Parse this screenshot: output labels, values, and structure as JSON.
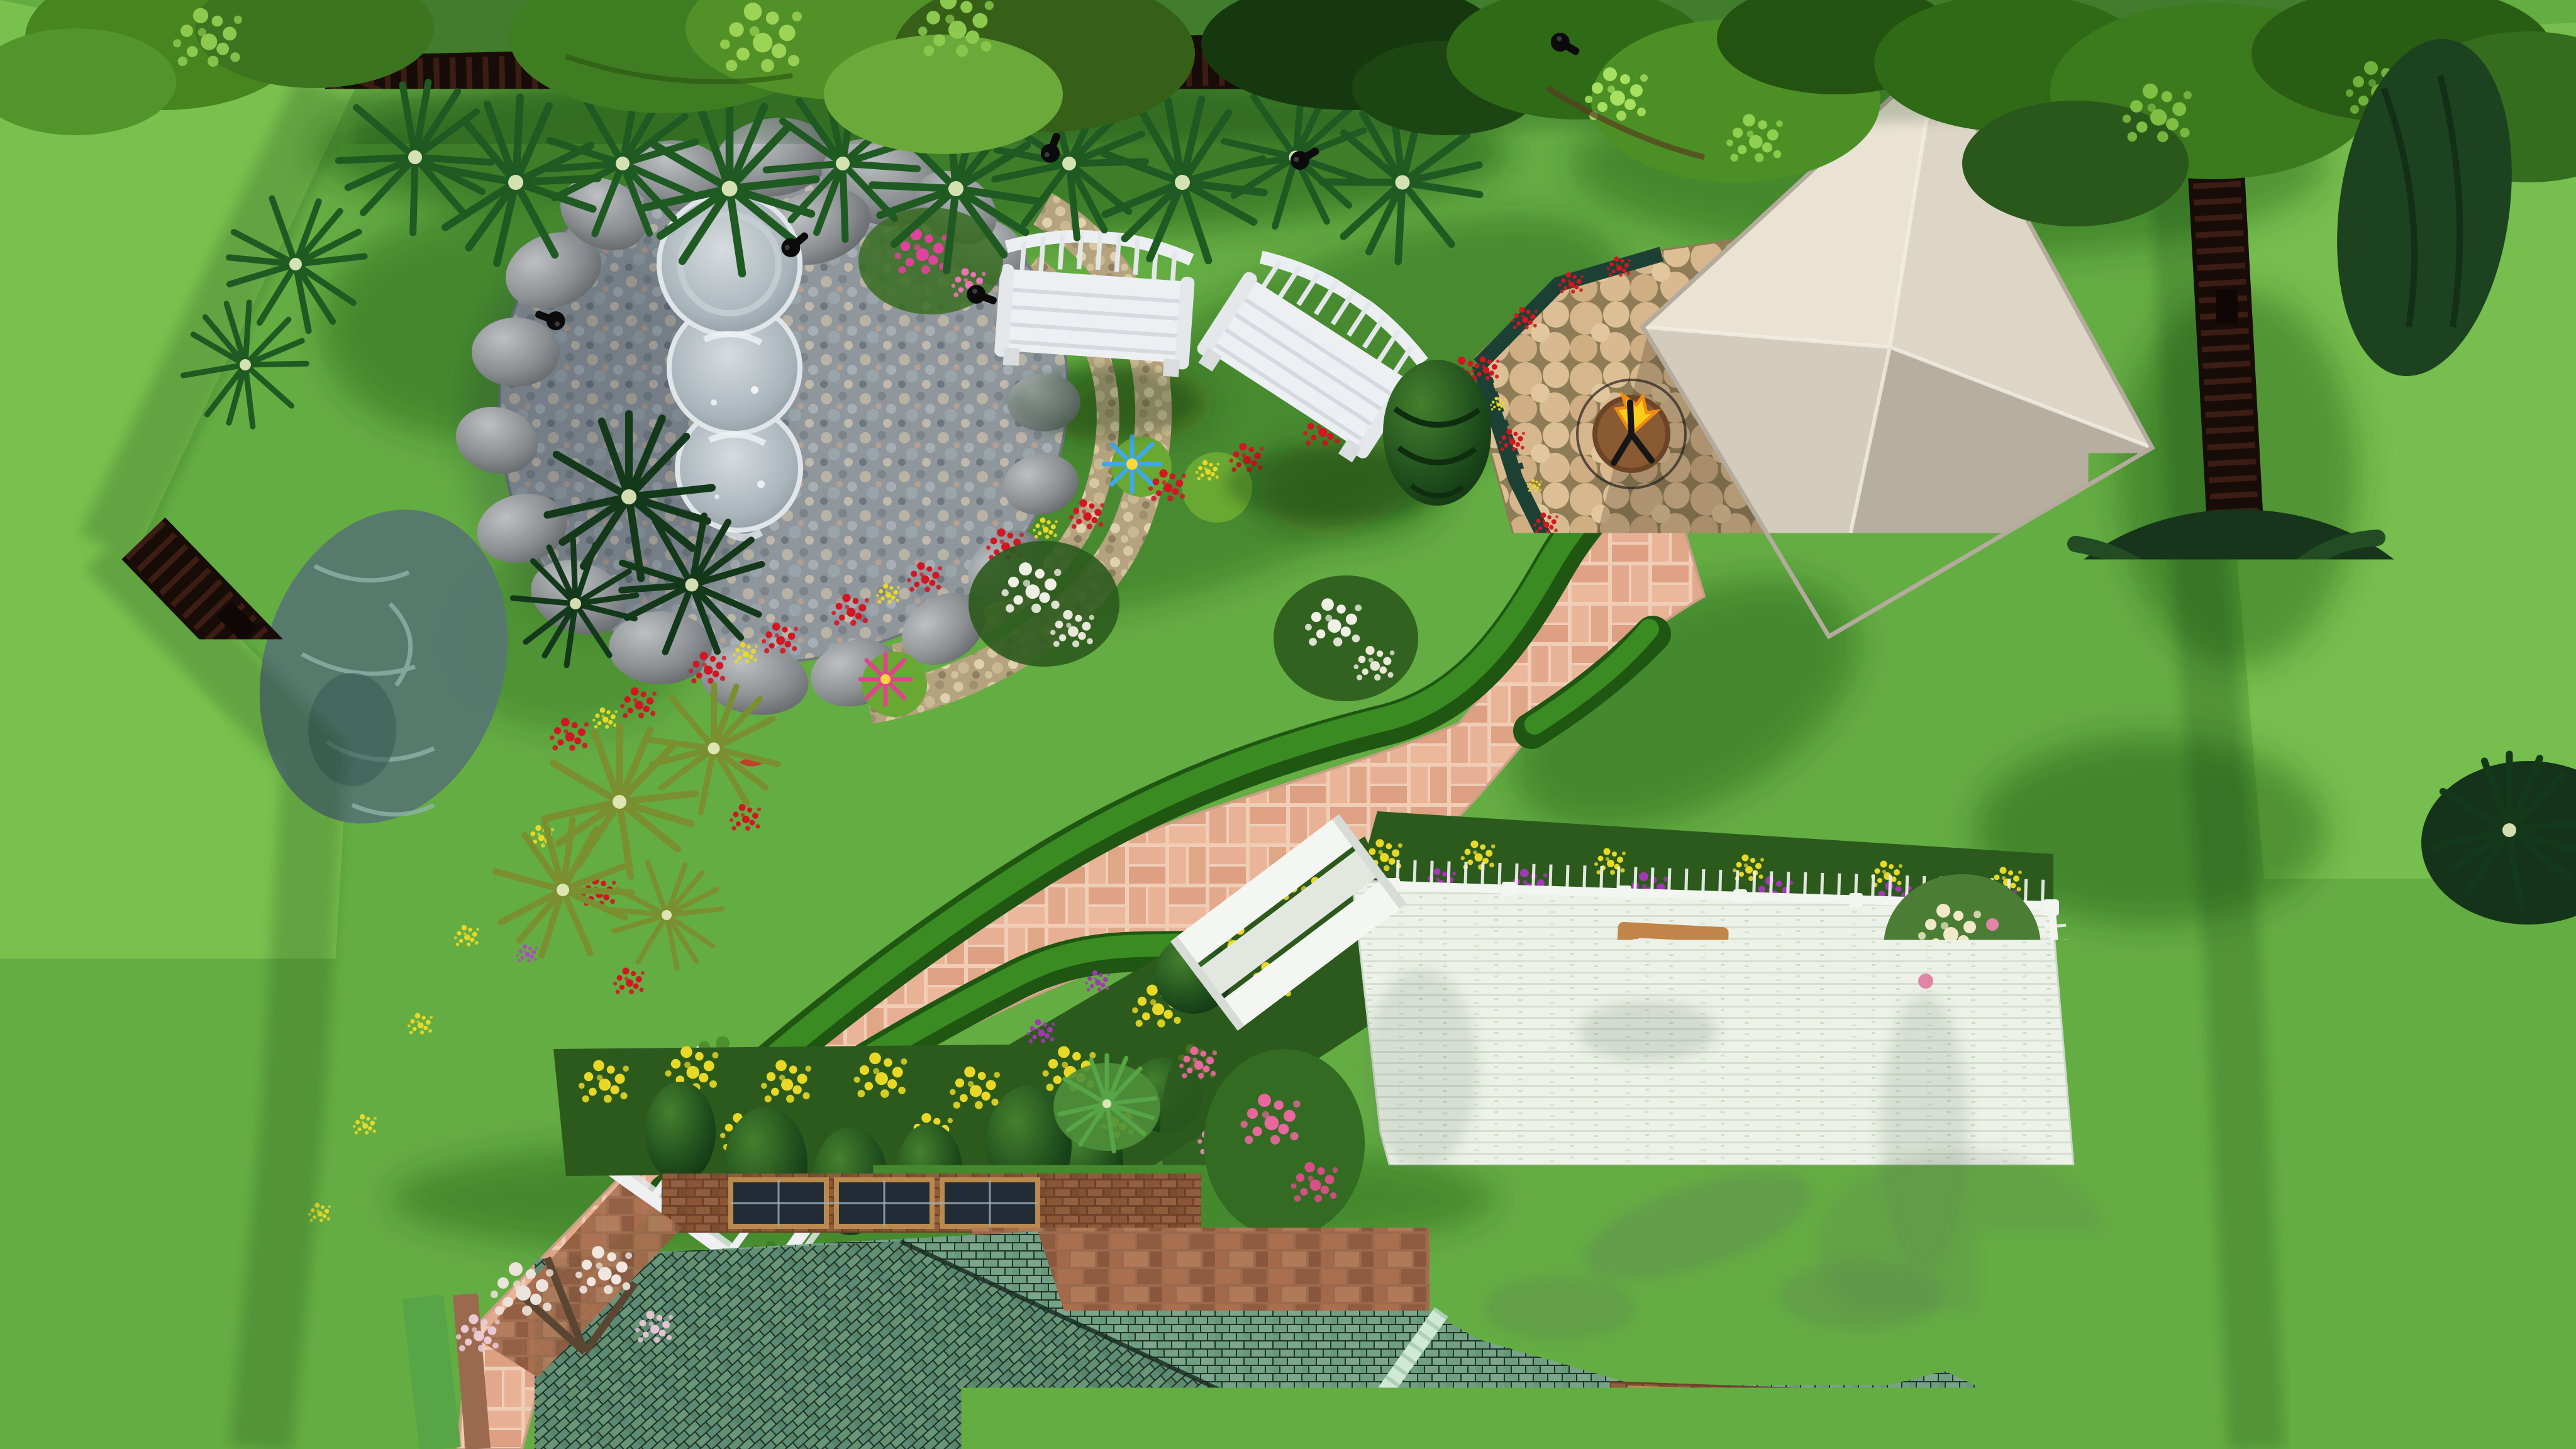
{
  "app": {
    "title": "Backyard landscape design - 3D top view render"
  },
  "palette": {
    "lawn": "#64ad43",
    "lawn_light": "#79c14f",
    "lawn_shadow": "#11340a",
    "fence_dark": "#180c08",
    "fence_slat": "#3b1d13",
    "boulder_gray": "#8d9194",
    "pebble_gray": "#919aa0",
    "pebble_tan": "#c3b18c",
    "fountain_stone": "#a9b4bc",
    "water_blue": "#3fa8e8",
    "lily_pad": "#69a832",
    "lily_pink": "#e2438a",
    "bench_white": "#edf0f2",
    "hedge_dark": "#1e5612",
    "hedge_light": "#3f9426",
    "brick_path": "#e5ae92",
    "flagstone_tan": "#d6b68d",
    "trellis_green": "#1d4034",
    "firepit_bowl": "#8a5a33",
    "flame_yellow": "#ffcc1a",
    "gazebo_nw": "#eae3d4",
    "gazebo_ne": "#ddd6c7",
    "gazebo_sw": "#d3cbbc",
    "gazebo_se": "#c3bbac",
    "deck_floor": "#edf2e8",
    "rail_white": "#f3f5f1",
    "glass_blue": "#9fb2cb",
    "chair_wood": "#c18449",
    "cushion": "#e9e6df",
    "counter_white": "#f1f2ef",
    "sink_steel": "#b3b8bc",
    "roof_green": "#6f9e83",
    "roof_green_dark": "#5d8a74",
    "roof_ridge": "#cfe9d6",
    "wall_brick": "#8a5636",
    "window_dark": "#222c36",
    "window_frame": "#b98a4e",
    "flower_red": "#d21622",
    "flower_yellow": "#e9d926",
    "flower_purple": "#a238b4",
    "flower_pink": "#e8679d",
    "flower_white": "#f0efe5",
    "conifer_dark": "#16351b",
    "foliage_mid": "#3f7d22",
    "foliage_light": "#8cc94e",
    "light_fixture": "#0b0b0b"
  },
  "scene": {
    "view": "top-down 3D render",
    "objects": [
      {
        "id": "pond",
        "label": "Pebble pond with boulder edge"
      },
      {
        "id": "fountain",
        "label": "Three-tier round stone fountain"
      },
      {
        "id": "water-lilies",
        "label": "Blue and pink water lilies with pads"
      },
      {
        "id": "garden-bench",
        "label": "White garden benches",
        "count": 2
      },
      {
        "id": "cone-topiary",
        "label": "Spiral cone topiary"
      },
      {
        "id": "gazebo",
        "label": "Gazebo with cream pyramid canvas roof"
      },
      {
        "id": "flagstone-patio",
        "label": "Tan flagstone patio"
      },
      {
        "id": "fire-pit",
        "label": "Copper fire pit with flame"
      },
      {
        "id": "rose-trellis",
        "label": "Dark green trellis with red climbing roses"
      },
      {
        "id": "metal-bench",
        "label": "Green metal garden bench"
      },
      {
        "id": "paver-path",
        "label": "Pink brick paver walkway"
      },
      {
        "id": "arbor",
        "label": "White garden arbor over path"
      },
      {
        "id": "hedges",
        "label": "Clipped boxwood hedges lining path"
      },
      {
        "id": "flower-border",
        "label": "Red and yellow flower border"
      },
      {
        "id": "flower-beds",
        "label": "Yellow and purple annual beds"
      },
      {
        "id": "ball-topiary",
        "label": "Ball topiaries",
        "count": 4
      },
      {
        "id": "egg-topiary",
        "label": "Egg topiaries by house",
        "count": 5
      },
      {
        "id": "deck",
        "label": "White wood deck with railing and steps"
      },
      {
        "id": "patio-table",
        "label": "Round glass patio table"
      },
      {
        "id": "deck-chair",
        "label": "Wood deck chairs with white cushions",
        "count": 3
      },
      {
        "id": "outdoor-sink",
        "label": "Outdoor kitchen counter with double sink"
      },
      {
        "id": "hydrangea",
        "label": "White hydrangea shrub"
      },
      {
        "id": "pink-shrub",
        "label": "Pink flowering shrubs"
      },
      {
        "id": "house-roof",
        "label": "House with green shingle roof and skylight windows"
      },
      {
        "id": "perimeter-fence",
        "label": "Dark brown slat perimeter fence"
      },
      {
        "id": "shade-trees",
        "label": "Shade trees overhanging fence"
      },
      {
        "id": "conifers",
        "label": "Dark conifers along right fence"
      },
      {
        "id": "spotlights",
        "label": "Black landscape spotlights"
      },
      {
        "id": "butterfly",
        "label": "Small purple butterfly on lawn"
      }
    ]
  }
}
